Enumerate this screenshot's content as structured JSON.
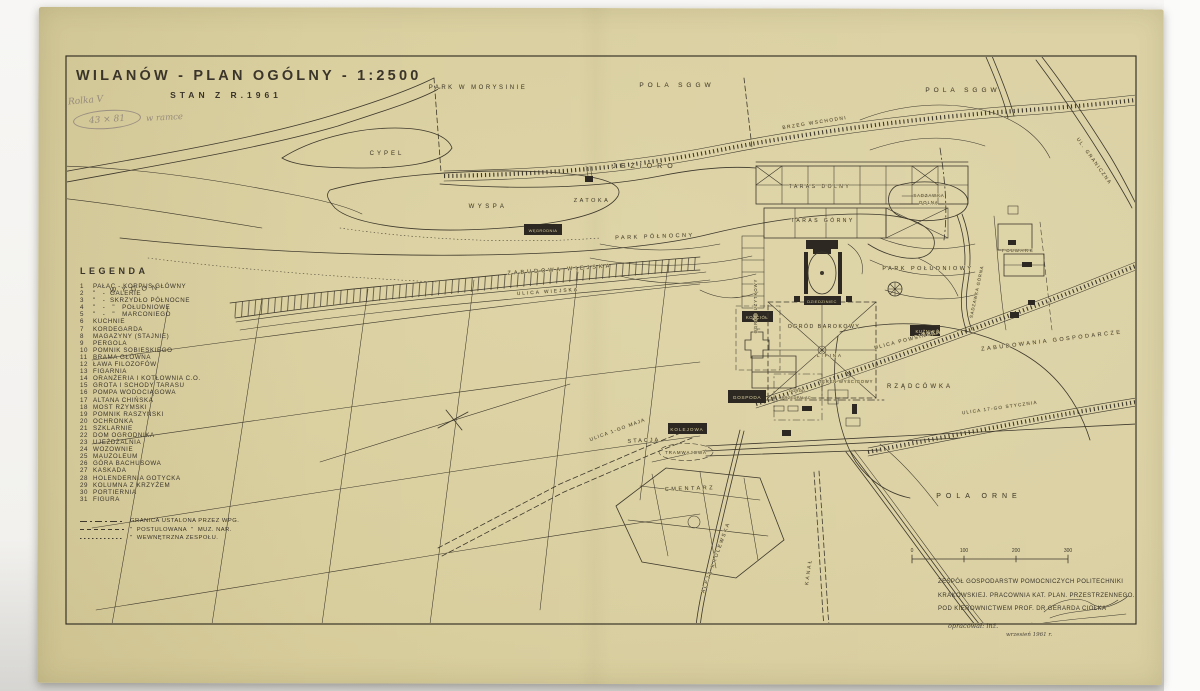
{
  "title": {
    "main": "WILANÓW - PLAN OGÓLNY - 1:2500",
    "subtitle": "STAN Z R.1961"
  },
  "annotations": {
    "roll": "Rolka V",
    "size": "43 × 81",
    "note": "w ramce"
  },
  "legend": {
    "title": "LEGENDA",
    "items": [
      {
        "n": "1",
        "label": "PAŁAC - KORPUS GŁÓWNY"
      },
      {
        "n": "2",
        "label": "\"   -  GALERIE"
      },
      {
        "n": "3",
        "label": "\"   -  SKRZYDŁO PÓŁNOCNE"
      },
      {
        "n": "4",
        "label": "\"   -   \"   POŁUDNIOWE"
      },
      {
        "n": "5",
        "label": "\"   -   \"   MARCONIEGO"
      },
      {
        "n": "6",
        "label": "KUCHNIE"
      },
      {
        "n": "7",
        "label": "KORDEGARDA"
      },
      {
        "n": "8",
        "label": "MAGAZYNY (STAJNIE)"
      },
      {
        "n": "9",
        "label": "PERGOLA"
      },
      {
        "n": "10",
        "label": "POMNIK SOBIESKIEGO"
      },
      {
        "n": "11",
        "label": "BRAMA GŁÓWNA"
      },
      {
        "n": "12",
        "label": "ŁAWA FILOZOFÓW"
      },
      {
        "n": "13",
        "label": "FIGARNIA"
      },
      {
        "n": "14",
        "label": "ORANŻERIA I KOTŁOWNIA C.O."
      },
      {
        "n": "15",
        "label": "GROTA I SCHODY TARASU"
      },
      {
        "n": "16",
        "label": "POMPA WODOCIĄGOWA"
      },
      {
        "n": "17",
        "label": "ALTANA CHIŃSKA"
      },
      {
        "n": "18",
        "label": "MOST RZYMSKI"
      },
      {
        "n": "19",
        "label": "POMNIK RASZYŃSKI"
      },
      {
        "n": "20",
        "label": "OCHRONKA"
      },
      {
        "n": "21",
        "label": "SZKLARNIE"
      },
      {
        "n": "22",
        "label": "DOM OGRODNIKA"
      },
      {
        "n": "23",
        "label": "UJEŻDŻALNIA"
      },
      {
        "n": "24",
        "label": "WOZOWNIE"
      },
      {
        "n": "25",
        "label": "MAUZOLEUM"
      },
      {
        "n": "26",
        "label": "GÓRA BACHUSOWA"
      },
      {
        "n": "27",
        "label": "KASKADA"
      },
      {
        "n": "28",
        "label": "HOLENDERNIA GOTYCKA"
      },
      {
        "n": "29",
        "label": "KOLUMNA Z KRZYŻEM"
      },
      {
        "n": "30",
        "label": "PORTIERNIA"
      },
      {
        "n": "31",
        "label": "FIGURA"
      }
    ],
    "boundaries": [
      {
        "label": "GRANICA USTALONA PRZEZ WPG."
      },
      {
        "label": "\"  POSTULOWANA  \"  MUZ. NAR."
      },
      {
        "label": "\"  WEWNĘTRZNA ZESPOŁU."
      }
    ]
  },
  "map_labels": {
    "park_w_morysinie": "PARK W MORYSINIE",
    "pola_sggw": "POLA SGGW",
    "brzeg_wschodni": "BRZEG WSCHODNI",
    "ul_graniczna": "UL. GRANICZNA",
    "cypel": "CYPEL",
    "jezioro": "JEZIORO",
    "wyspa": "WYSPA",
    "zatoka": "ZATOKA",
    "wygon": "WYGON",
    "park_polnocny": "PARK PÓŁNOCNY",
    "wegrodnia": "WĘGRODNIA",
    "taras_dolny": "TARAS DOLNY",
    "taras_gorny": "TARAS GÓRNY",
    "sadzawka_dolna_1": "SADZAWKA",
    "sadzawka_dolna_2": "DOLNA",
    "park_poludniowy": "PARK POŁUDNIOWY",
    "sadzawka_gorna": "SADZAWKA GÓRNA",
    "folwark": "FOLWARK",
    "zabudowania_gospodarcze": "ZABUDOWANIA GOSPODARCZE",
    "zabudowa_wiejska": "ZABUDOWA WIEJSKA",
    "ulica_wiejska": "ULICA WIEJSKA",
    "ogrod_uzytkowy": "OGRÓD UŻYTKOWY",
    "kosciol": "KOŚCIÓŁ",
    "dziedziniec": "DZIEDZINIEC",
    "ogrod_barokowy": "OGRÓD BAROKOWY",
    "lipina": "LIPINA",
    "kuznia": "KUŹNIA",
    "ulica_powsinska": "ULICA POWSIŃSKA",
    "rzadcowka": "RZĄDCÓWKA",
    "teren_wyscigowy": "TEREN WYŚCIGOWY",
    "ogrod_przedpalac_1": "OGRÓD",
    "ogrod_przedpalac_2": "PRZEDPAŁAC.",
    "gospoda": "GOSPODA",
    "ulica_1go_maja": "ULICA 1-GO MAJA",
    "stacja": "STACJA",
    "kolejowa": "KOLEJOWA",
    "tramwajowa": "TRAMWAJOWA",
    "cmentarz": "CMENTARZ",
    "aleja_krolewska": "ALEJA KRÓLEWSKA",
    "kanal": "KANAŁ",
    "ulica_17go_stycznia": "ULICA 17-GO STYCZNIA",
    "pola_orne": "POLA ORNE"
  },
  "scalebar": {
    "ticks": [
      "0",
      "100",
      "200",
      "300"
    ]
  },
  "credits": {
    "line1": "ZESPÓŁ GOSPODARSTW POMOCNICZYCH POLITECHNIKI",
    "line2": "KRAKOWSKIEJ. PRACOWNIA KAT. PLAN. PRZESTRZENNEGO.",
    "line3": "POD KIEROWNICTWEM PROF. DR GERARDA CIOŁKA",
    "prepared": "opracował: inż.",
    "date": "wrzesień 1961 r."
  },
  "colors": {
    "paper": "#d8cd9c",
    "ink": "#3e382c",
    "pencil": "#9a9184"
  }
}
